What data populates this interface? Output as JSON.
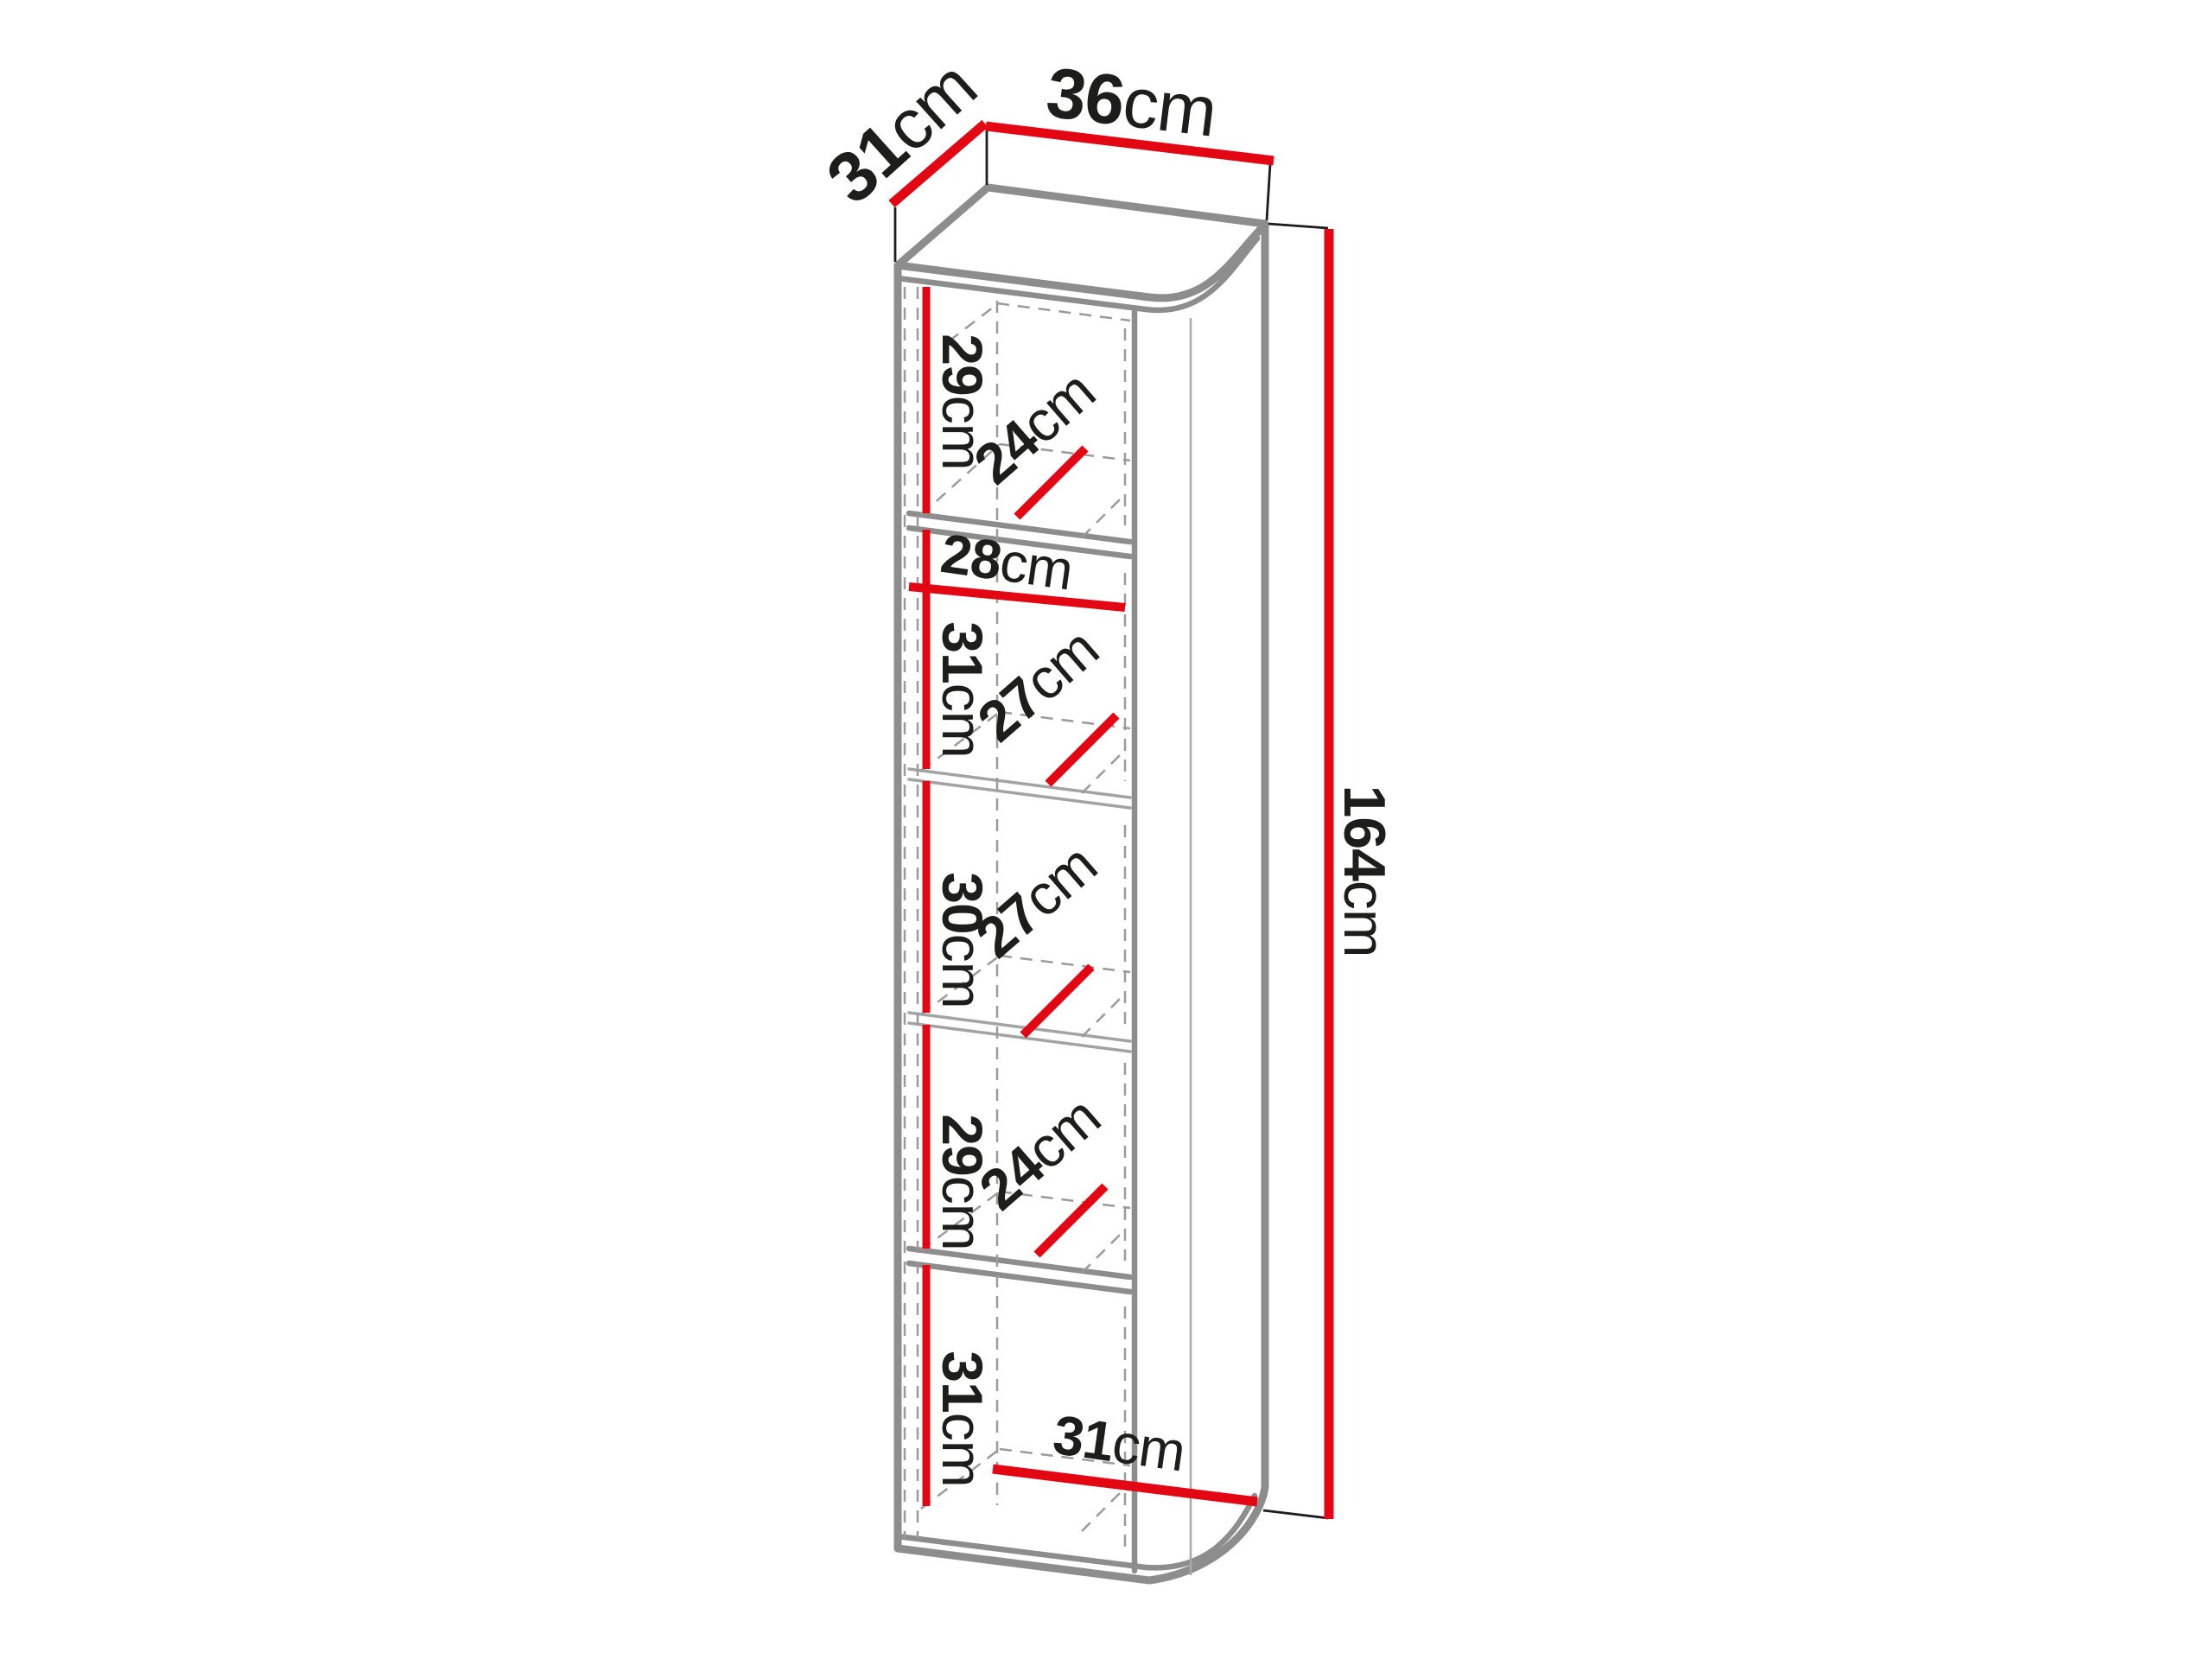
{
  "diagram": {
    "type": "furniture-dimension-drawing",
    "subject": "tall narrow cabinet with rounded front-right edge, five interior compartments",
    "overall": {
      "depth": {
        "value": "31",
        "unit": "cm"
      },
      "width": {
        "value": "36",
        "unit": "cm"
      },
      "height": {
        "value": "164",
        "unit": "cm"
      }
    },
    "interior_width": {
      "value": "28",
      "unit": "cm"
    },
    "bottom_width": {
      "value": "31",
      "unit": "cm"
    },
    "compartments": [
      {
        "height": {
          "value": "29",
          "unit": "cm"
        },
        "depth": {
          "value": "24",
          "unit": "cm"
        }
      },
      {
        "height": {
          "value": "31",
          "unit": "cm"
        },
        "depth": {
          "value": "27",
          "unit": "cm"
        }
      },
      {
        "height": {
          "value": "30",
          "unit": "cm"
        },
        "depth": {
          "value": "27",
          "unit": "cm"
        }
      },
      {
        "height": {
          "value": "29",
          "unit": "cm"
        },
        "depth": {
          "value": "24",
          "unit": "cm"
        }
      },
      {
        "height": {
          "value": "31",
          "unit": "cm"
        }
      }
    ],
    "colors": {
      "dimension_red": "#e30613",
      "edge_gray": "#8d8d8d",
      "text_black": "#1d1d1b",
      "background": "#ffffff"
    }
  }
}
